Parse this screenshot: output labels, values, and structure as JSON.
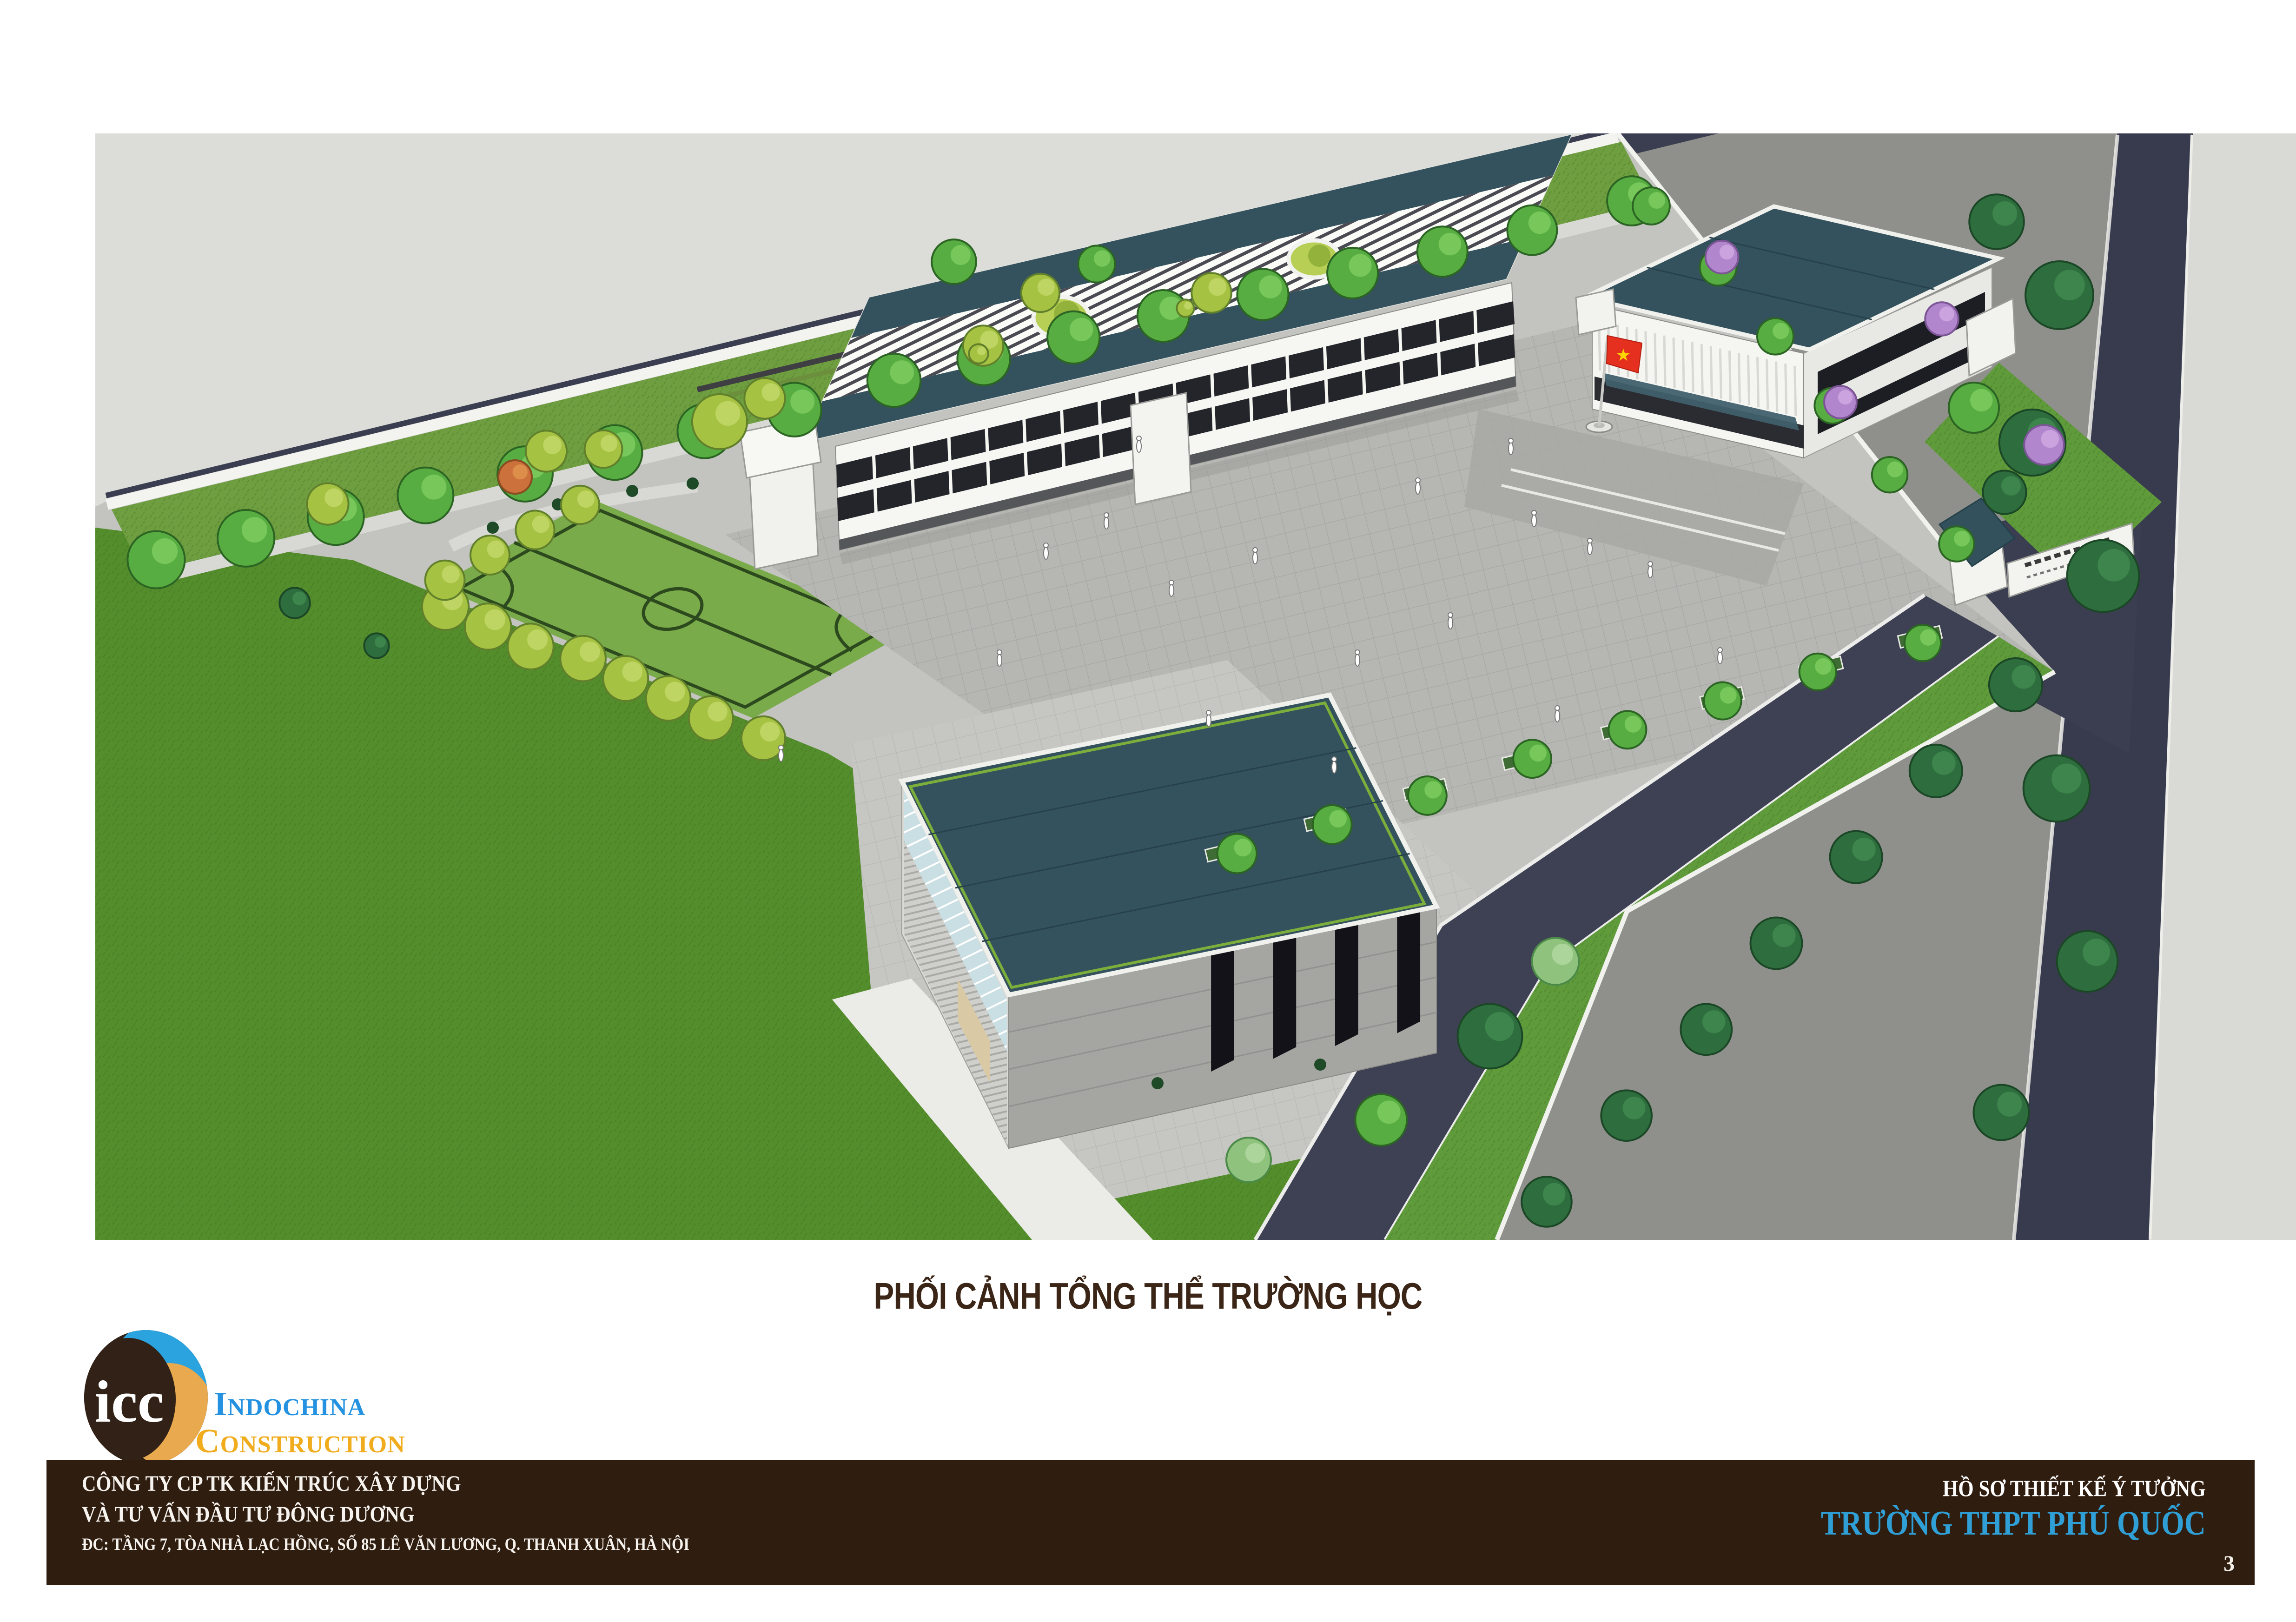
{
  "caption": "PHỐI CẢNH TỔNG THỂ TRƯỜNG HỌC",
  "logo": {
    "monogram": "icc",
    "word1": "Indochina",
    "word2": "Construction"
  },
  "footer": {
    "company_line1": "CÔNG TY CP TK KIẾN TRÚC XÂY DỰNG",
    "company_line2": "VÀ TƯ VẤN ĐẦU TƯ ĐÔNG DƯƠNG",
    "company_address": "ĐC: TẦNG 7, TÒA NHÀ LẠC HỒNG, SỐ 85 LÊ VĂN LƯƠNG, Q. THANH XUÂN, HÀ NỘI",
    "dossier_type": "HỒ SƠ THIẾT KẾ Ý TƯỞNG",
    "project_name": "TRƯỜNG THPT PHÚ QUỐC",
    "page_number": "3"
  },
  "colors": {
    "bar_brown": "#2f1d10",
    "title_brown": "#3a2516",
    "logo_blue": "#2492e0",
    "logo_gold": "#f0ac1c",
    "project_blue": "#2f9fd6",
    "roof_teal": "#34525d",
    "road_navy": "#3b3e50",
    "outer_light_gray": "#dcddd8",
    "outer_mid_gray": "#8f908c",
    "plaza_gray": "#b6b6b3",
    "lawn_green": "#548d2b",
    "field_green": "#7aab4b",
    "tree_green": "#57ad42",
    "flag_red": "#e5301f",
    "flag_star_yellow": "#ffd400"
  }
}
